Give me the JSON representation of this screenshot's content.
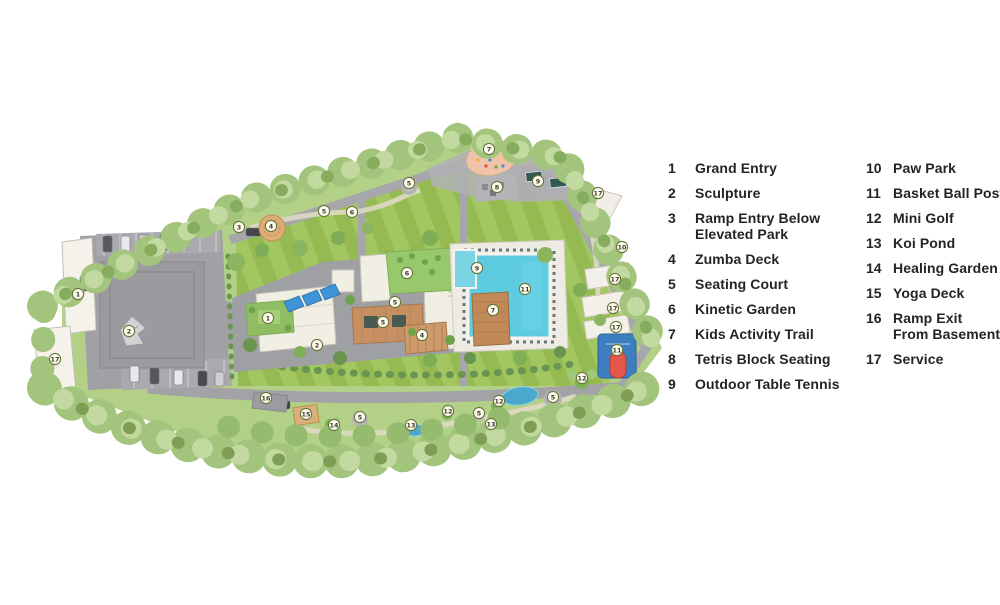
{
  "legend": {
    "col1": [
      {
        "num": "1",
        "label": "Grand Entry"
      },
      {
        "num": "2",
        "label": "Sculpture"
      },
      {
        "num": "3",
        "label": "Ramp Entry Below\nElevated Park"
      },
      {
        "num": "4",
        "label": "Zumba Deck"
      },
      {
        "num": "5",
        "label": "Seating Court"
      },
      {
        "num": "6",
        "label": "Kinetic Garden"
      },
      {
        "num": "7",
        "label": "Kids Activity Trail"
      },
      {
        "num": "8",
        "label": "Tetris Block Seating"
      },
      {
        "num": "9",
        "label": "Outdoor Table Tennis"
      }
    ],
    "col2": [
      {
        "num": "10",
        "label": "Paw Park"
      },
      {
        "num": "11",
        "label": "Basket Ball Post"
      },
      {
        "num": "12",
        "label": "Mini Golf"
      },
      {
        "num": "13",
        "label": "Koi Pond"
      },
      {
        "num": "14",
        "label": "Healing Garden"
      },
      {
        "num": "15",
        "label": "Yoga Deck"
      },
      {
        "num": "16",
        "label": "Ramp Exit\nFrom Basement"
      },
      {
        "num": "17",
        "label": "Service"
      }
    ]
  },
  "map": {
    "colors": {
      "outer_lawn": "#b2d187",
      "striped_lawn_light": "#a2c660",
      "striped_lawn_dark": "#96ba52",
      "road": "#a7a7ab",
      "plaza": "#a1a1a5",
      "building": "#f1eee4",
      "pool": "#5dcbe0",
      "wood_deck": "#c08a58",
      "tree": "#a3c47c",
      "basketball_court": "#3c7ec0",
      "basketball_post": "#e2574a",
      "koi_pond": "#49a8cc",
      "marker_fill": "#fdfbee",
      "marker_ring": "#68753b",
      "legend_text": "#232428"
    },
    "markers": [
      {
        "n": "1",
        "x": 78,
        "y": 294
      },
      {
        "n": "2",
        "x": 129,
        "y": 331
      },
      {
        "n": "17",
        "x": 55,
        "y": 359
      },
      {
        "n": "3",
        "x": 239,
        "y": 227
      },
      {
        "n": "4",
        "x": 271,
        "y": 226
      },
      {
        "n": "5",
        "x": 324,
        "y": 211
      },
      {
        "n": "6",
        "x": 352,
        "y": 212
      },
      {
        "n": "5",
        "x": 409,
        "y": 183
      },
      {
        "n": "7",
        "x": 489,
        "y": 149
      },
      {
        "n": "8",
        "x": 497,
        "y": 187
      },
      {
        "n": "9",
        "x": 538,
        "y": 181
      },
      {
        "n": "17",
        "x": 598,
        "y": 193
      },
      {
        "n": "10",
        "x": 622,
        "y": 247
      },
      {
        "n": "17",
        "x": 615,
        "y": 279
      },
      {
        "n": "17",
        "x": 613,
        "y": 308
      },
      {
        "n": "17",
        "x": 616,
        "y": 327
      },
      {
        "n": "11",
        "x": 617,
        "y": 350
      },
      {
        "n": "12",
        "x": 582,
        "y": 378
      },
      {
        "n": "5",
        "x": 553,
        "y": 397
      },
      {
        "n": "12",
        "x": 499,
        "y": 401
      },
      {
        "n": "5",
        "x": 479,
        "y": 413
      },
      {
        "n": "13",
        "x": 491,
        "y": 424
      },
      {
        "n": "12",
        "x": 448,
        "y": 411
      },
      {
        "n": "13",
        "x": 411,
        "y": 425
      },
      {
        "n": "5",
        "x": 360,
        "y": 417
      },
      {
        "n": "14",
        "x": 334,
        "y": 425
      },
      {
        "n": "15",
        "x": 306,
        "y": 414
      },
      {
        "n": "16",
        "x": 266,
        "y": 398
      },
      {
        "n": "6",
        "x": 407,
        "y": 273
      },
      {
        "n": "5",
        "x": 395,
        "y": 302
      },
      {
        "n": "1",
        "x": 268,
        "y": 318
      },
      {
        "n": "2",
        "x": 317,
        "y": 345
      },
      {
        "n": "5",
        "x": 383,
        "y": 322
      },
      {
        "n": "4",
        "x": 422,
        "y": 335
      },
      {
        "n": "7",
        "x": 493,
        "y": 310
      },
      {
        "n": "11",
        "x": 525,
        "y": 289
      },
      {
        "n": "9",
        "x": 477,
        "y": 268
      }
    ]
  }
}
